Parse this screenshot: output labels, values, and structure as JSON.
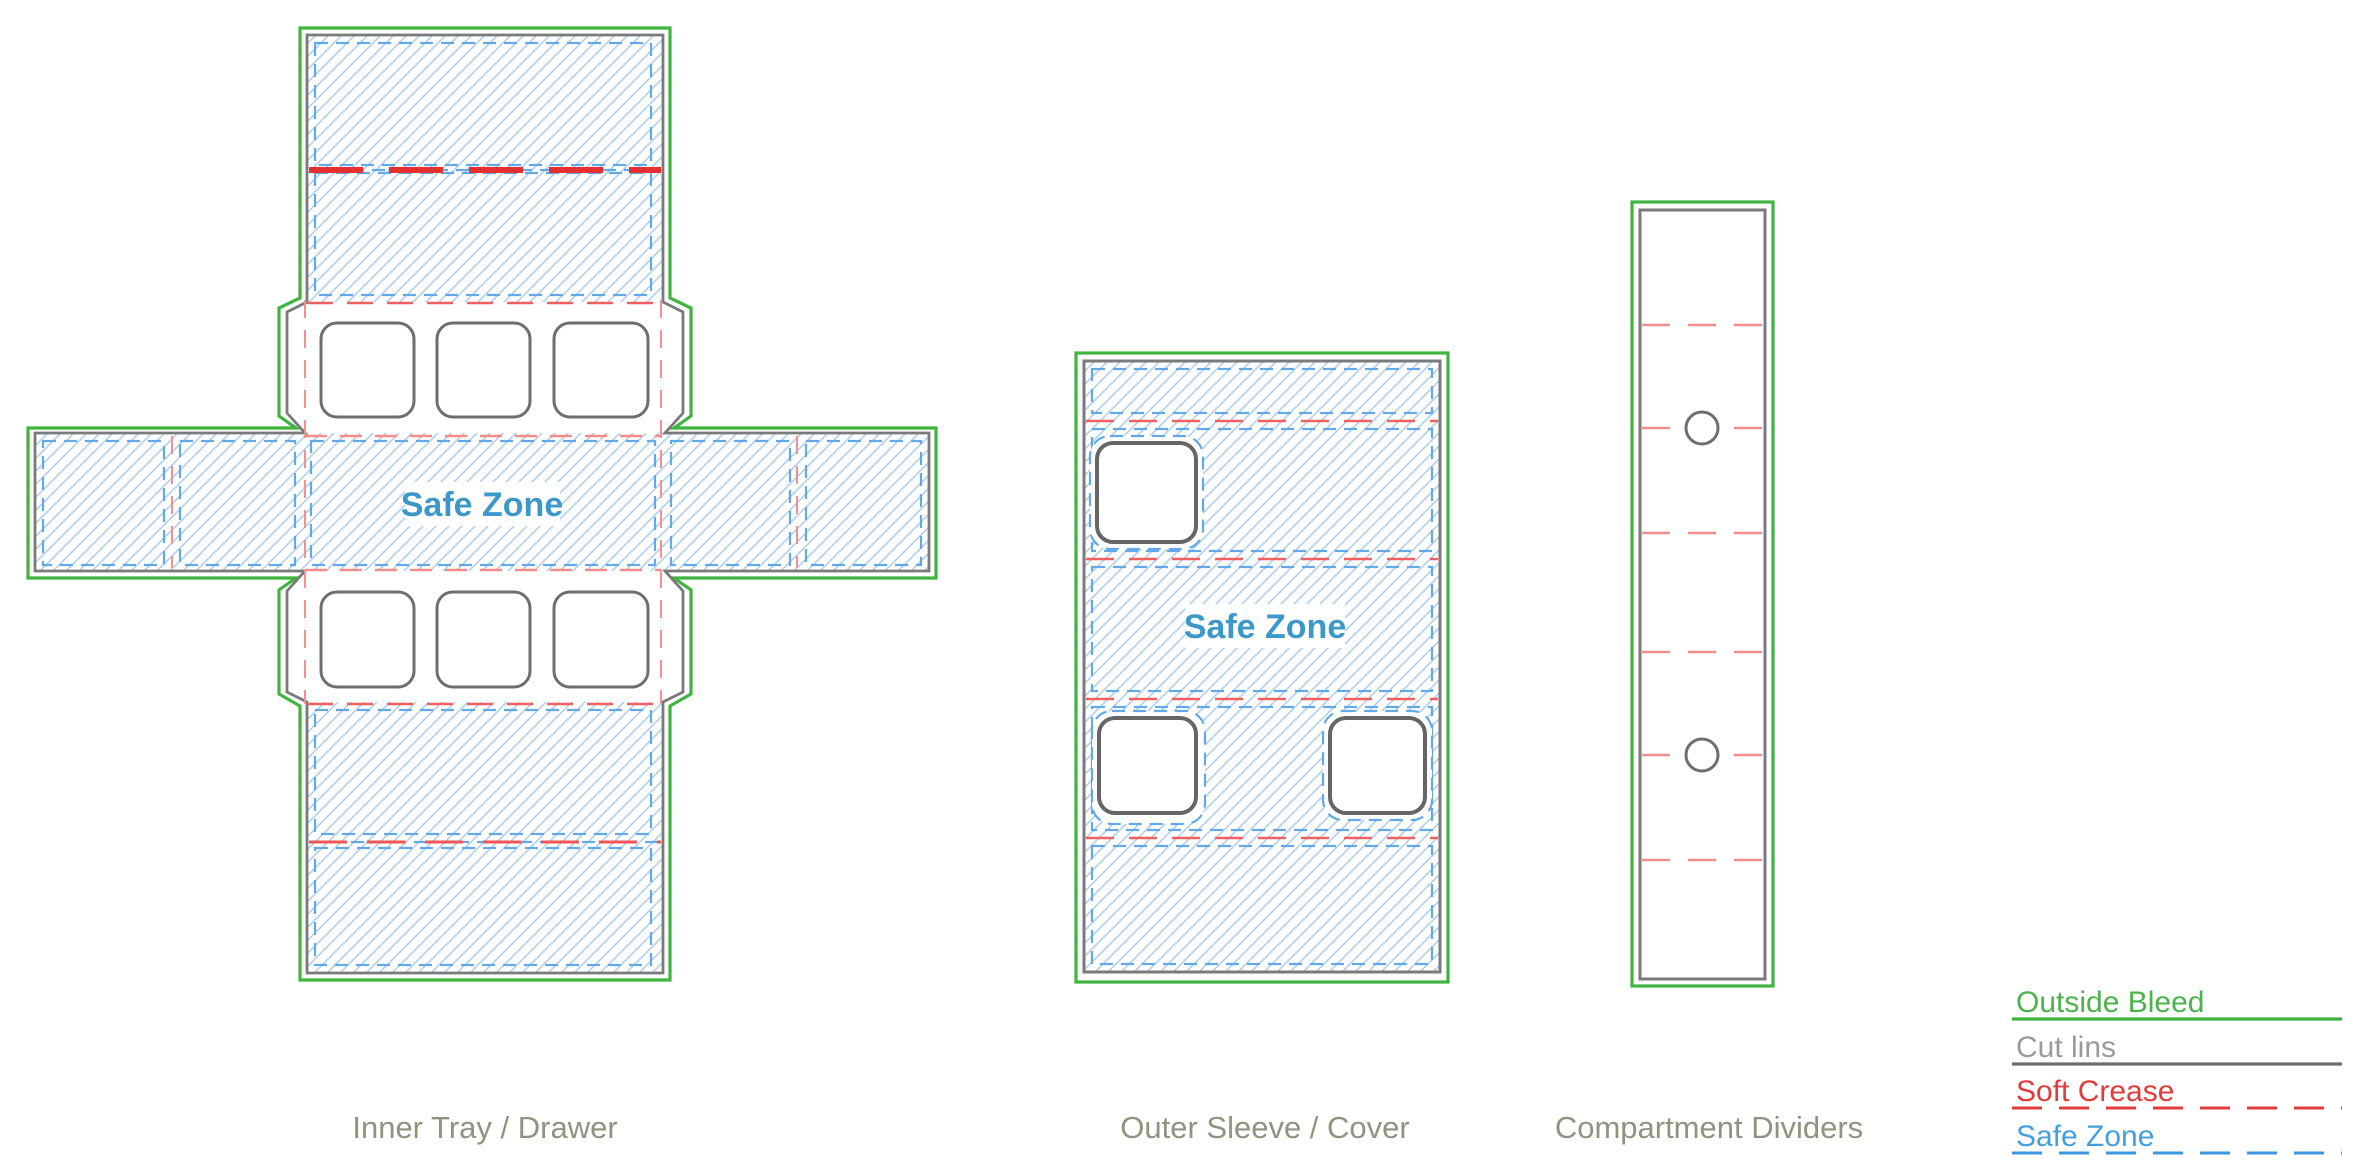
{
  "diagram": {
    "inner_tray": {
      "label": "Inner Tray / Drawer",
      "safe_zone": "Safe Zone"
    },
    "outer_sleeve": {
      "label": "Outer Sleeve / Cover",
      "safe_zone": "Safe Zone"
    },
    "dividers": {
      "label": "Compartment Dividers"
    }
  },
  "legend": {
    "items": [
      {
        "label": "Outside Bleed",
        "color": "#3fb53f",
        "line_style": "solid"
      },
      {
        "label": "Cut lins",
        "color": "#9a9a9a",
        "line_color": "#6e6e6e",
        "line_style": "solid"
      },
      {
        "label": "Soft Crease",
        "color": "#e23b3b",
        "line_style": "dashed"
      },
      {
        "label": "Safe Zone",
        "color": "#44a0dd",
        "line_style": "dashed"
      }
    ]
  },
  "colors": {
    "outside_bleed": "#3fb53f",
    "cut_line": "#7a7a7a",
    "soft_crease_strong": "#e62f2f",
    "soft_crease_medium": "#f06060",
    "soft_crease_light": "#f58c8c",
    "safe_zone_dash": "#63a9e8",
    "hatch": "#aacdee",
    "safe_zone_text": "#3d98ca",
    "caption_text": "#8e947e",
    "background": "#ffffff"
  }
}
